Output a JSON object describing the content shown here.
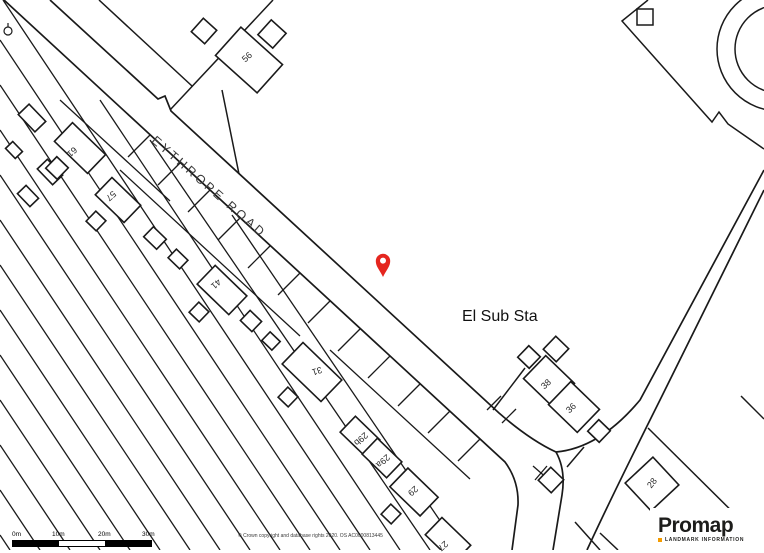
{
  "map": {
    "road_label": "EYTHROPE ROAD",
    "substation_label": "El Sub Sta",
    "house_numbers": [
      "56",
      "61",
      "57",
      "41",
      "31",
      "29b",
      "29a",
      "29",
      "27",
      "38",
      "36",
      "28"
    ],
    "marker": {
      "name": "location-pin",
      "color": "#e5261f"
    },
    "line_color": "#1a1a1a"
  },
  "scale_bar": {
    "labels": [
      "0m",
      "10m",
      "20m",
      "30m"
    ]
  },
  "attribution": "© Crown copyright and database rights 2020. OS AC0000813445",
  "branding": {
    "name": "Promap",
    "tagline": "LANDMARK INFORMATION",
    "accent_color": "#f59c00"
  }
}
